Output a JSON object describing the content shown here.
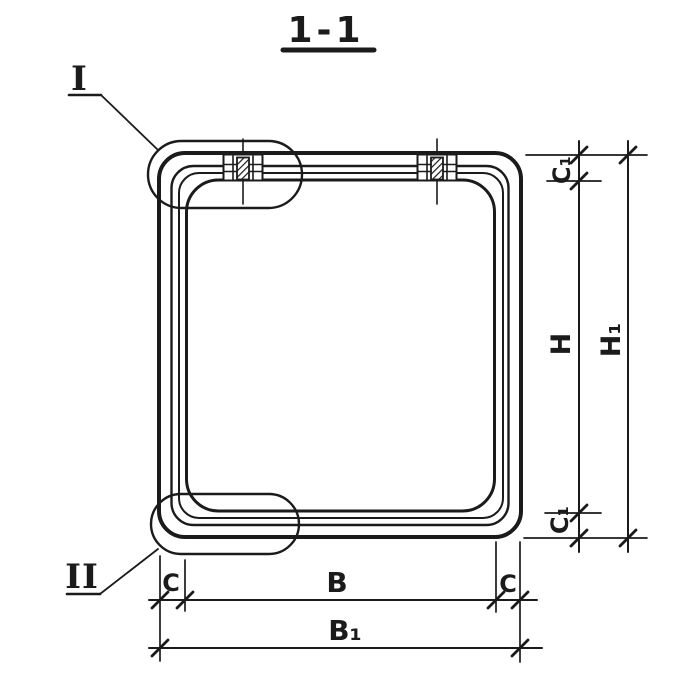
{
  "drawing": {
    "title": "1-1",
    "callouts": {
      "detail_1": "I",
      "detail_2": "II"
    },
    "dims": {
      "c1_top": "C₁",
      "h": "H",
      "h1": "H₁",
      "c1_bottom": "C₁",
      "c_left": "C",
      "b": "B",
      "c_right": "C",
      "b1": "B₁"
    },
    "colors": {
      "ink": "#1b1b1b",
      "paper": "#ffffff"
    }
  }
}
